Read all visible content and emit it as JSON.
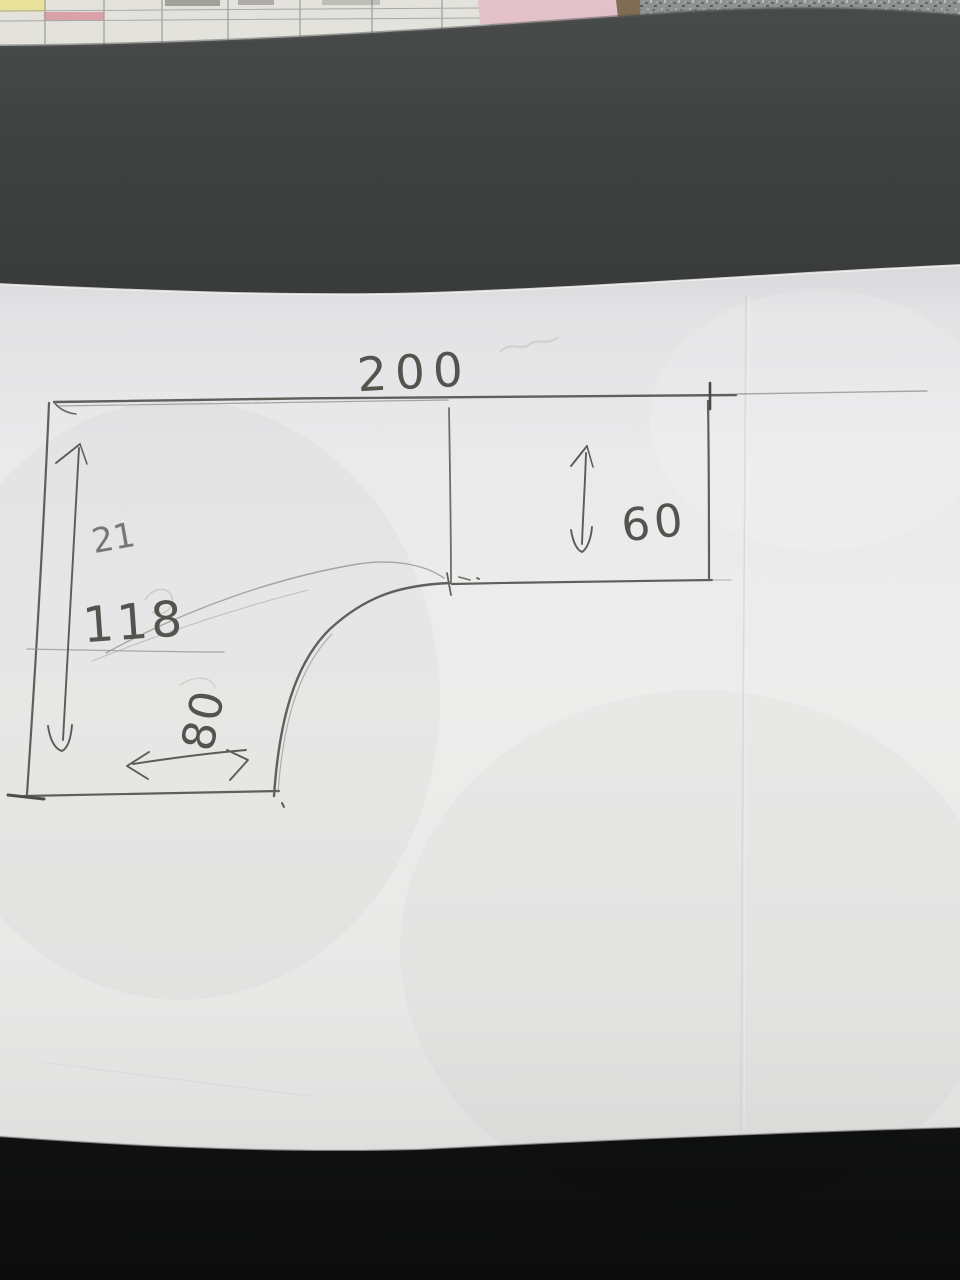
{
  "scene": {
    "caption": "Photograph of a hand-drawn pencil sketch on white paper lying on a dark desk, with clutter (calendar sheet, pink paper, carpet) visible at the very top edge",
    "subject": "Dimensioned sketch of an L-shaped desktop / countertop with a rounded inner corner"
  },
  "sketch": {
    "shape_name": "L-shaped outline with rounded inner corner",
    "dimension_labels": {
      "top_width": "200",
      "right_depth": "60",
      "left_height": "118",
      "bottom_width": "80",
      "faint_erased": "21"
    },
    "annotations": {
      "top_width_desc": "overall width across the top edge",
      "right_depth_desc": "depth of right wing, vertical double arrow",
      "left_height_desc": "left side height, vertical double arrow",
      "bottom_width_desc": "bottom leg width, horizontal double arrow, numeral written sideways"
    }
  },
  "colors": {
    "pencil_dark": "#5d5b56",
    "pencil_medium": "#8b8984",
    "pencil_faint": "#a39f99",
    "paper": "#ebebec",
    "paper_edge_shadow": "#d9d9db",
    "desk_top_band": "#3c3f3e",
    "desk_bottom_black": "#0e0f0e",
    "carpet_gray": "#8f9290",
    "calendar_yellow": "#e9e29a",
    "calendar_pink_row": "#d9a2a9",
    "pink_paper": "#e3c1c8",
    "wood_strip": "#7e6d52"
  }
}
